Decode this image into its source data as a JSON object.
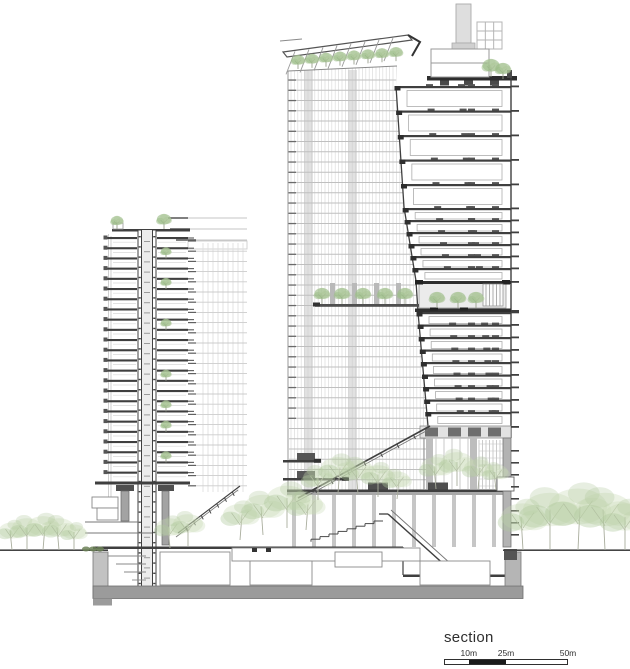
{
  "title": {
    "text": "section"
  },
  "scalebar": {
    "total_m": 50,
    "width_px": 124,
    "labels": [
      {
        "text": "10m",
        "m": 10
      },
      {
        "text": "25m",
        "m": 25
      },
      {
        "text": "50m",
        "m": 50
      }
    ],
    "segments": [
      {
        "from_m": 0,
        "to_m": 10,
        "fill": "#ffffff"
      },
      {
        "from_m": 10,
        "to_m": 25,
        "fill": "#1a1a1a"
      },
      {
        "from_m": 25,
        "to_m": 50,
        "fill": "#ffffff"
      }
    ]
  },
  "palette": {
    "ink": "#3f3f3f",
    "ink_dark": "#2e2e2e",
    "ink_soft": "#6a6a6a",
    "grey_fill": "#9b9b9b",
    "grey_mid": "#b8b8b8",
    "grey_light": "#d6d6d6",
    "mesh": "#c4c4c4",
    "mesh_faint": "#dcdcdc",
    "tree_green": "#9dbd88",
    "tree_tone1": "#c6d9b4",
    "tree_tone2": "#aec79a",
    "hedge_green": "#6c8157",
    "trunk": "#9aa08e",
    "white": "#ffffff"
  },
  "scene": {
    "ground_y": 550,
    "bg_building": {
      "left": 188,
      "right": 247,
      "grid_top": 241,
      "bottom": 492,
      "row_h": 10.2,
      "col_step": 5,
      "roof_lines": [
        [
          168,
          218
        ],
        [
          170,
          229
        ],
        [
          176,
          240
        ]
      ]
    },
    "left_tower": {
      "left": 108,
      "right": 188,
      "top": 230,
      "first_floor_y": 238,
      "floor_h": 10.2,
      "floors": 24,
      "core_left": 138,
      "core_right": 156,
      "transfer_y": 483,
      "balcony_tree_floors": [
        2,
        5,
        9,
        14,
        17,
        19,
        22
      ],
      "parapet_trees": [
        117,
        164
      ]
    },
    "right_tower": {
      "mesh_left": 288,
      "mesh_top": 66,
      "mesh_bottom": 492,
      "edge_points": [
        [
          86,
          396
        ],
        [
          207,
          404
        ],
        [
          281,
          416
        ],
        [
          312,
          418
        ],
        [
          426,
          428
        ]
      ],
      "right": 511,
      "roof_y": 77,
      "bands": [
        {
          "y0": 86,
          "n": 5,
          "h": 24.5,
          "inner_h": 16
        },
        {
          "y0": 208,
          "n": 6,
          "h": 12.0,
          "inner_h": 6.5
        },
        {
          "y0": 312,
          "n": 9,
          "h": 12.5,
          "inner_h": 7
        }
      ],
      "sky_garden": {
        "x": 419,
        "y": 281,
        "w": 87,
        "h": 31,
        "screen_x": 483,
        "trees": [
          437,
          458,
          476
        ]
      },
      "garden_row": {
        "slab_y": 304,
        "x0": 315,
        "x1": 419,
        "cols": [
          330,
          352,
          374,
          396
        ],
        "trees": [
          322,
          342,
          363,
          385,
          405
        ]
      },
      "mep": {
        "y": 426,
        "h": 12,
        "blocks": [
          425,
          448,
          468,
          488
        ]
      },
      "canopy": {
        "x0": 283,
        "y0": 52,
        "x1": 408,
        "y1": 35
      },
      "canopy_trees": [
        298,
        312,
        326,
        340,
        354,
        368,
        382,
        396
      ],
      "roof_plant": {
        "chimney": [
          456,
          4,
          15,
          39
        ],
        "frame": [
          477,
          22,
          25,
          27
        ],
        "box": [
          431,
          49,
          58,
          28
        ],
        "trees": [
          [
            491,
            77,
            9
          ],
          [
            503,
            79,
            8
          ]
        ],
        "notches": [
          440,
          464,
          490
        ]
      },
      "atrium": {
        "x0": 424,
        "x1": 506,
        "y0": 438,
        "y1": 489,
        "columns": [
          426,
          470
        ],
        "screen_x": 479
      },
      "terraces": [
        {
          "y": 460,
          "x0": 283,
          "x1": 320
        },
        {
          "y": 478,
          "x0": 283,
          "x1": 348
        }
      ],
      "mid_slab_y": 489.5,
      "diag1": [
        [
          430,
          426
        ],
        [
          298,
          498
        ]
      ],
      "diag2": [
        [
          240,
          486
        ],
        [
          178,
          533
        ]
      ],
      "escalator": [
        [
          388,
          514
        ],
        [
          458,
          577
        ]
      ],
      "stair": {
        "x0": 383,
        "y0": 521,
        "steps": 8,
        "dx": -9,
        "dy": 2.6
      }
    },
    "podium": {
      "x0": 93,
      "x1": 523,
      "ground_slab_x1": 403,
      "sunken_y": 575,
      "slab_top": 586,
      "slab_h": 12.5,
      "rooms": [
        [
          160,
          552,
          70,
          33
        ],
        [
          232,
          548,
          188,
          13
        ],
        [
          250,
          561,
          62,
          24
        ],
        [
          335,
          552,
          47,
          15
        ],
        [
          420,
          561,
          70,
          24
        ]
      ],
      "right_wall": [
        503,
        438,
        8,
        109
      ]
    },
    "trees": {
      "left": [
        [
          12,
          550,
          13
        ],
        [
          27,
          550,
          15
        ],
        [
          43,
          550,
          16
        ],
        [
          59,
          550,
          15
        ],
        [
          74,
          550,
          12
        ]
      ],
      "right": [
        [
          523,
          550,
          22
        ],
        [
          550,
          550,
          27
        ],
        [
          578,
          550,
          29
        ],
        [
          605,
          550,
          27
        ],
        [
          625,
          550,
          22
        ]
      ],
      "mid": [
        [
          170,
          548,
          14
        ],
        [
          188,
          546,
          15
        ],
        [
          240,
          540,
          17
        ],
        [
          263,
          535,
          19
        ],
        [
          287,
          528,
          20
        ],
        [
          306,
          530,
          17
        ]
      ],
      "atrium": [
        [
          318,
          500,
          15
        ],
        [
          338,
          493,
          17
        ],
        [
          358,
          494,
          16
        ],
        [
          378,
          497,
          15
        ],
        [
          397,
          499,
          13
        ],
        [
          436,
          489,
          15
        ],
        [
          457,
          486,
          16
        ],
        [
          478,
          489,
          14
        ],
        [
          496,
          490,
          12
        ]
      ],
      "hedge": [
        [
          86,
          549
        ],
        [
          93,
          549
        ],
        [
          100,
          549
        ]
      ]
    }
  }
}
